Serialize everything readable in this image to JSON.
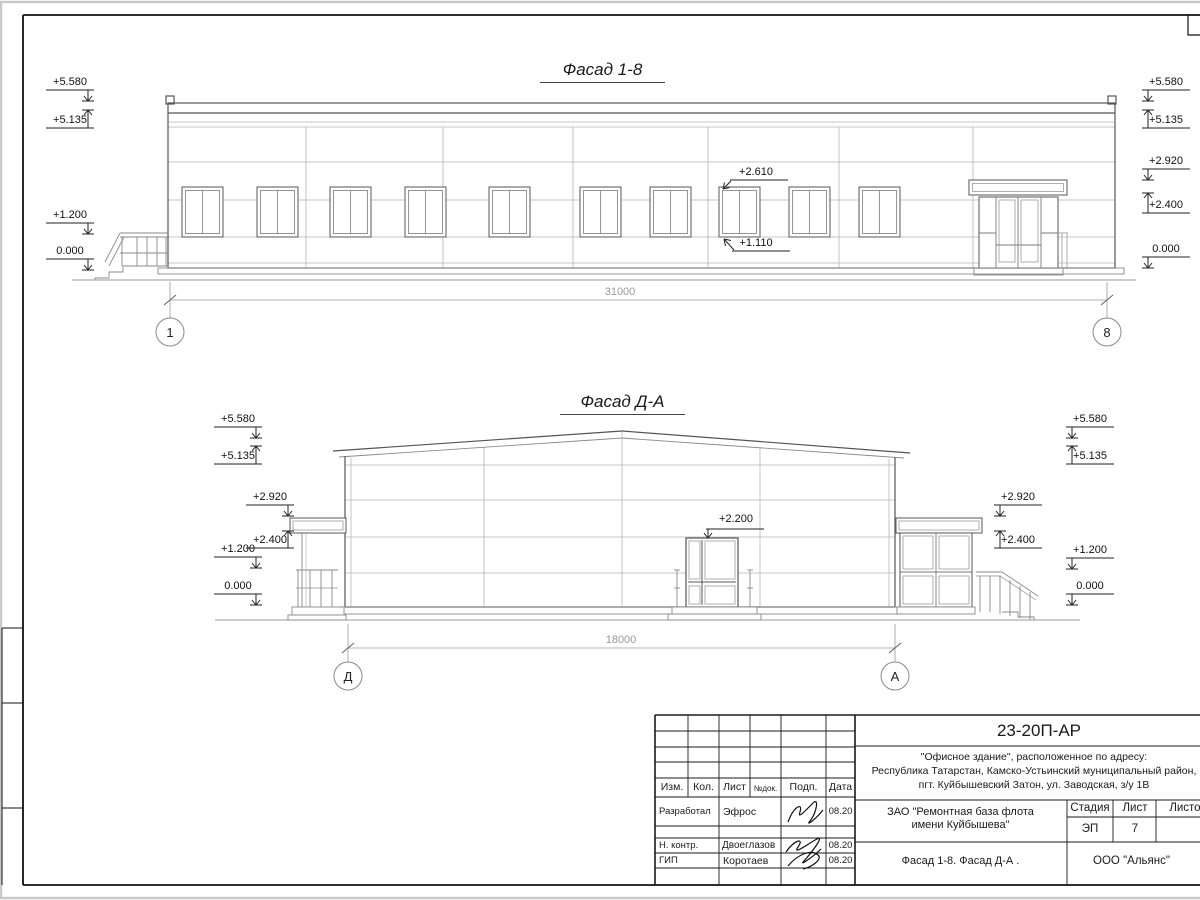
{
  "facade1": {
    "title": "Фасад 1-8",
    "dim": "31000",
    "axes": [
      "1",
      "8"
    ],
    "marks_left": [
      "+5.580",
      "+5.135",
      "+1.200",
      "0.000"
    ],
    "marks_right": [
      "+5.580",
      "+5.135",
      "+2.920",
      "+2.400",
      "0.000"
    ],
    "win_top": "+2.610",
    "win_bot": "+1.110"
  },
  "facade2": {
    "title": "Фасад Д-А",
    "dim": "18000",
    "axes": [
      "Д",
      "А"
    ],
    "marks_left": [
      "+5.580",
      "+5.135",
      "+2.920",
      "+2.400",
      "+1.200",
      "0.000"
    ],
    "marks_right": [
      "+5.580",
      "+5.135",
      "+2.920",
      "+2.400",
      "+1.200",
      "0.000"
    ],
    "door_mark": "+2.200"
  },
  "titleblock": {
    "doc_number": "23-20П-АР",
    "address_line1": "\"Офисное здание\", расположенное по адресу:",
    "address_line2": "Республика Татарстан, Камско-Устьинский муниципальный район,",
    "address_line3": "пгт. Куйбышевский Затон, ул. Заводская, з/у 1В",
    "client_line1": "ЗАО \"Ремонтная база флота",
    "client_line2": "имени Куйбышева\"",
    "sheet_title": "Фасад 1-8. Фасад Д-А .",
    "organization": "ООО \"Альянс\"",
    "stage_header": "Стадия",
    "stage": "ЭП",
    "sheet_header": "Лист",
    "sheet_number": "7",
    "sheets_header": "Листов",
    "cols": [
      "Изм.",
      "Кол.",
      "Лист",
      "№док.",
      "Подп.",
      "Дата"
    ],
    "rows": [
      {
        "role": "Разработал",
        "name": "Эфрос",
        "date": "08.20"
      },
      {
        "role": "Н. контр.",
        "name": "Двоеглазов",
        "date": "08.20"
      },
      {
        "role": "ГИП",
        "name": "Коротаев",
        "date": "08.20"
      }
    ]
  }
}
